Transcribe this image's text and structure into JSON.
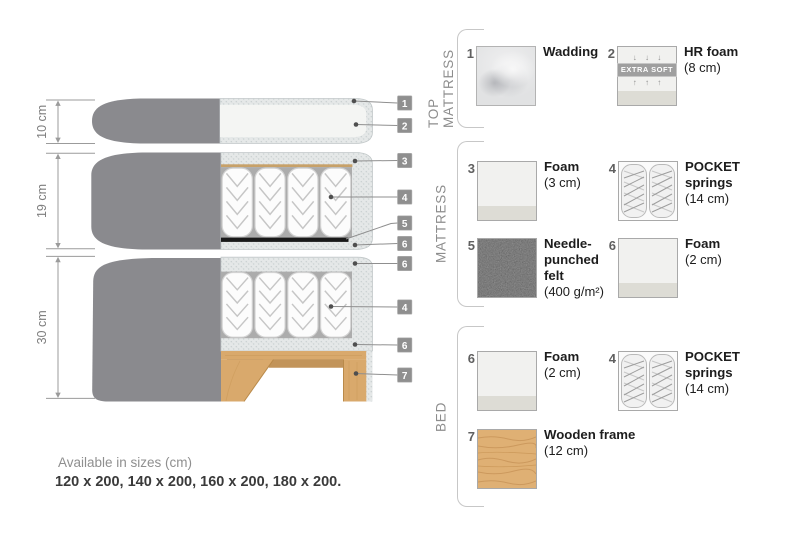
{
  "diagram": {
    "dim_labels": [
      "10 cm",
      "19 cm",
      "30 cm"
    ],
    "tags": [
      "1",
      "2",
      "3",
      "4",
      "5",
      "6",
      "6",
      "4",
      "6",
      "7"
    ]
  },
  "legend": {
    "sections": [
      {
        "label": "TOP MATTRESS",
        "items": [
          {
            "num": "1",
            "name": "Wadding",
            "dim": ""
          },
          {
            "num": "2",
            "name": "HR foam",
            "dim": "(8 cm)",
            "badge": "EXTRA SOFT",
            "arrows_down": "↓ ↓ ↓",
            "arrows_up": "↑ ↑ ↑"
          }
        ]
      },
      {
        "label": "MATTRESS",
        "items": [
          {
            "num": "3",
            "name": "Foam",
            "dim": "(3 cm)"
          },
          {
            "num": "4",
            "name": "POCKET\nsprings",
            "dim": "(14 cm)"
          },
          {
            "num": "5",
            "name": "Needle-\npunched\nfelt",
            "dim": "(400 g/m²)"
          },
          {
            "num": "6",
            "name": "Foam",
            "dim": "(2 cm)"
          }
        ]
      },
      {
        "label": "BED",
        "items": [
          {
            "num": "6",
            "name": "Foam",
            "dim": "(2 cm)"
          },
          {
            "num": "4",
            "name": "POCKET\nsprings",
            "dim": "(14 cm)"
          },
          {
            "num": "7",
            "name": "Wooden frame",
            "dim": "(12 cm)"
          }
        ]
      }
    ]
  },
  "footer": {
    "sizes_title": "Available in sizes (cm)",
    "sizes_values": "120 x 200, 140 x 200, 160 x 200, 180 x 200."
  },
  "colors": {
    "fabric": "#8a8a8e",
    "wood": "#d9a96c",
    "felt": "#191919",
    "tag": "#8f8f8f",
    "speckle_base": "#e5e8e8",
    "spring_bg": "#acacac"
  }
}
